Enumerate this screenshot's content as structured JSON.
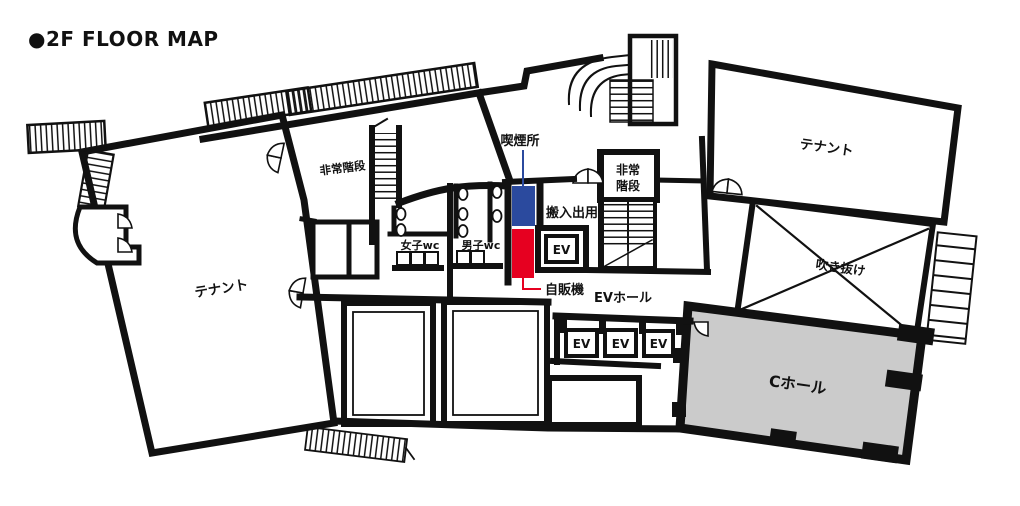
{
  "title": "●2F FLOOR MAP",
  "colors": {
    "wall": "#111111",
    "smoking_blue": "#2b4a9e",
    "vending_red": "#e60020",
    "c_hall_gray": "#cbcbcb"
  },
  "labels": {
    "tenant_left": "テナント",
    "tenant_right": "テナント",
    "emergency_stairs_left": "非常階段",
    "emergency_stairs_right_line1": "非常",
    "emergency_stairs_right_line2": "階段",
    "smoking_area": "喫煙所",
    "vending_machine": "自販機",
    "loading_entrance": "搬入出用",
    "womens_wc": "女子wc",
    "mens_wc": "男子wc",
    "elevator": "EV",
    "ev_hall": "EVホール",
    "atrium": "吹き抜け",
    "c_hall": "Cホール"
  }
}
